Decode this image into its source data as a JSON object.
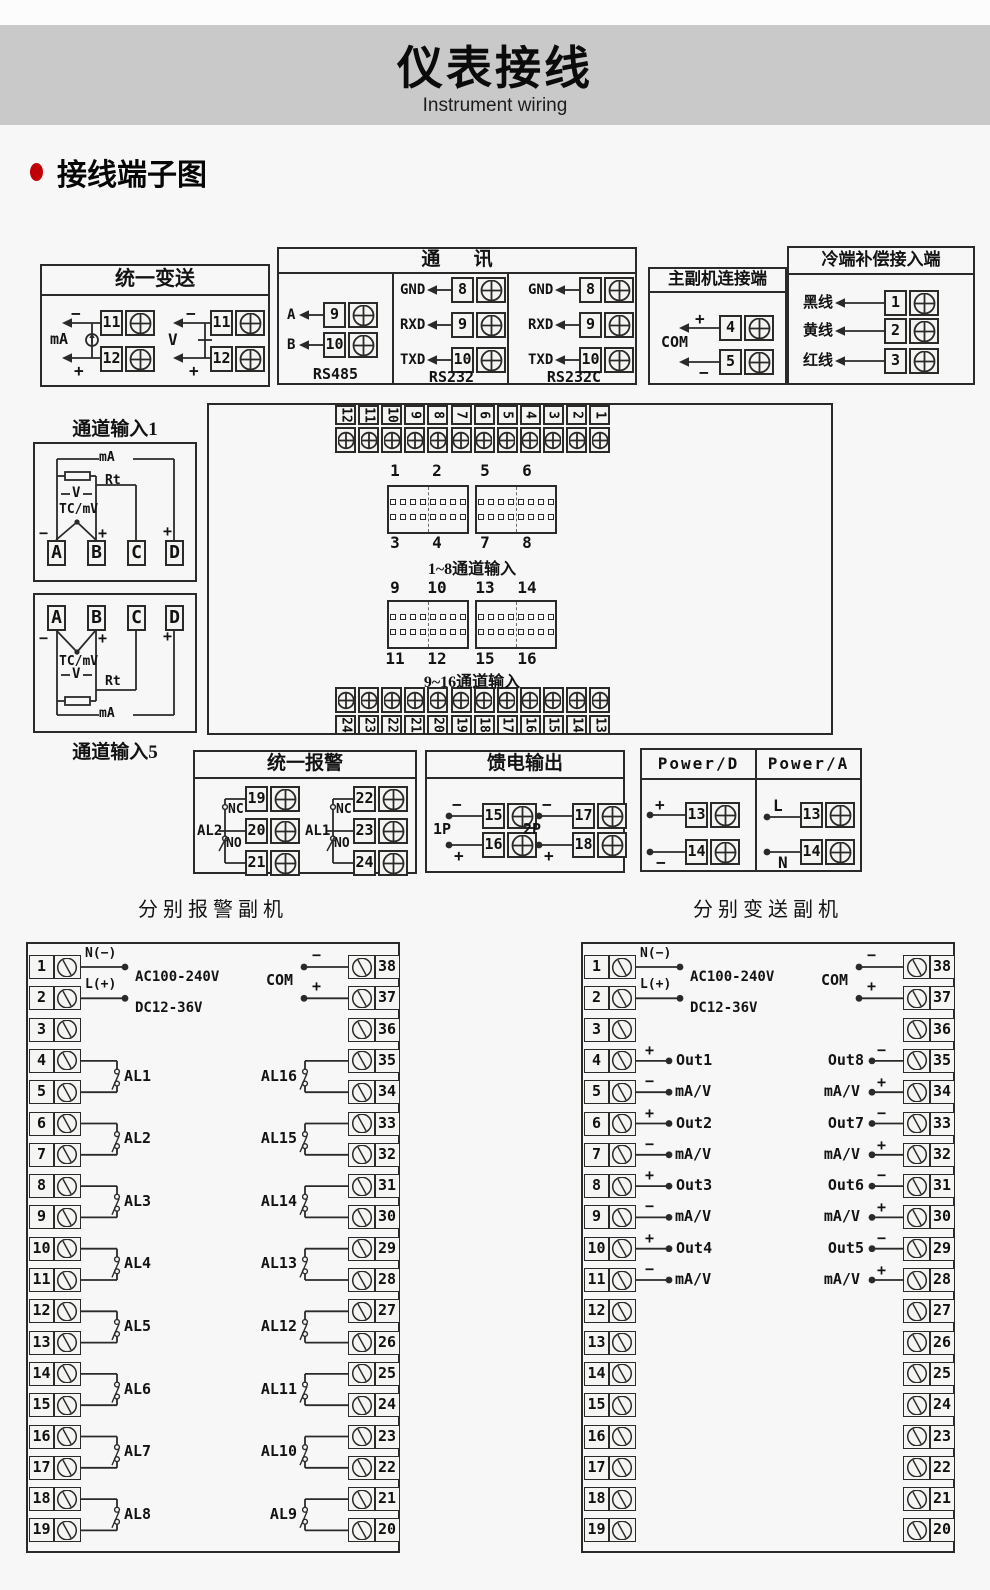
{
  "page": {
    "title": "仪表接线",
    "subtitle": "Instrument wiring",
    "section_title": "接线端子图"
  },
  "colors": {
    "accent_red": "#c00006",
    "line": "#2b2a28",
    "banner_bg": "#c9c9c9",
    "page_bg": "#f7f7f7"
  },
  "unified_transmit": {
    "title": "统一变送",
    "groups": [
      {
        "label": "mA",
        "minus": "−",
        "plus": "+",
        "terminals": [
          "11",
          "12"
        ]
      },
      {
        "label": "V",
        "minus": "−",
        "plus": "+",
        "terminals": [
          "11",
          "12"
        ]
      }
    ]
  },
  "comm": {
    "title": "通 讯",
    "columns": [
      {
        "caption": "RS485",
        "rows": [
          {
            "label": "A",
            "num": "9"
          },
          {
            "label": "B",
            "num": "10"
          }
        ]
      },
      {
        "caption": "RS232",
        "rows": [
          {
            "label": "GND",
            "num": "8"
          },
          {
            "label": "RXD",
            "num": "9"
          },
          {
            "label": "TXD",
            "num": "10"
          }
        ]
      },
      {
        "caption": "RS232C",
        "rows": [
          {
            "label": "GND",
            "num": "8"
          },
          {
            "label": "RXD",
            "num": "9"
          },
          {
            "label": "TXD",
            "num": "10"
          }
        ]
      }
    ]
  },
  "master_slave": {
    "title": "主副机连接端",
    "label": "COM",
    "rows": [
      {
        "sign": "+",
        "num": "4"
      },
      {
        "sign": "−",
        "num": "5"
      }
    ]
  },
  "cold_comp": {
    "title": "冷端补偿接入端",
    "rows": [
      {
        "label": "黑线",
        "num": "1"
      },
      {
        "label": "黄线",
        "num": "2"
      },
      {
        "label": "红线",
        "num": "3"
      }
    ]
  },
  "channel1": {
    "title": "通道输入1",
    "a": "A",
    "b": "B",
    "c": "C",
    "d": "D",
    "ma": "mA",
    "rt": "Rt",
    "v": "V",
    "tc": "TC/mV",
    "minus": "−",
    "plus_b": "+",
    "plus_d": "+"
  },
  "channel5": {
    "title": "通道输入5",
    "a": "A",
    "b": "B",
    "c": "C",
    "d": "D",
    "ma": "mA",
    "rt": "Rt",
    "v": "V",
    "tc": "TC/mV",
    "minus": "−",
    "plus_b": "+",
    "plus_d": "+"
  },
  "central": {
    "top_strip": [
      "12",
      "11",
      "10",
      "9",
      "8",
      "7",
      "6",
      "5",
      "4",
      "3",
      "2",
      "1"
    ],
    "bottom_strip": [
      "24",
      "23",
      "22",
      "21",
      "20",
      "19",
      "18",
      "17",
      "16",
      "15",
      "14",
      "13"
    ],
    "groups": [
      {
        "top": [
          "1",
          "2",
          "5",
          "6"
        ],
        "bottom": [
          "3",
          "4",
          "7",
          "8"
        ],
        "caption": "1~8通道输入"
      },
      {
        "top": [
          "9",
          "10",
          "13",
          "14"
        ],
        "bottom": [
          "11",
          "12",
          "15",
          "16"
        ],
        "caption": "9~16通道输入"
      }
    ]
  },
  "unified_alarm": {
    "title": "统一报警",
    "groups": [
      {
        "name": "AL2",
        "nc": "NC",
        "no": "NO",
        "terminals": [
          "19",
          "20",
          "21"
        ]
      },
      {
        "name": "AL1",
        "nc": "NC",
        "no": "NO",
        "terminals": [
          "22",
          "23",
          "24"
        ]
      }
    ]
  },
  "feed_output": {
    "title": "馈电输出",
    "groups": [
      {
        "name": "1P",
        "rows": [
          {
            "sign": "−",
            "num": "15"
          },
          {
            "sign": "+",
            "num": "16"
          }
        ]
      },
      {
        "name": "2P",
        "rows": [
          {
            "sign": "−",
            "num": "17"
          },
          {
            "sign": "+",
            "num": "18"
          }
        ]
      }
    ]
  },
  "power": {
    "columns": [
      {
        "title": "Power/D",
        "rows": [
          {
            "sign": "+",
            "num": "13"
          },
          {
            "sign": "−",
            "num": "14"
          }
        ]
      },
      {
        "title": "Power/A",
        "rows": [
          {
            "sign": "L",
            "num": "13"
          },
          {
            "sign": "N",
            "num": "14"
          }
        ]
      }
    ]
  },
  "alarm_slave": {
    "title": "分别报警副机",
    "power": {
      "n": "N(−)",
      "l": "L(+)",
      "ac": "AC100-240V",
      "dc": "DC12-36V",
      "com": "COM",
      "minus": "−",
      "plus": "+"
    },
    "left_terminals": [
      "1",
      "2",
      "3",
      "4",
      "5",
      "6",
      "7",
      "8",
      "9",
      "10",
      "11",
      "12",
      "13",
      "14",
      "15",
      "16",
      "17",
      "18",
      "19"
    ],
    "right_terminals": [
      "38",
      "37",
      "36",
      "35",
      "34",
      "33",
      "32",
      "31",
      "30",
      "29",
      "28",
      "27",
      "26",
      "25",
      "24",
      "23",
      "22",
      "21",
      "20"
    ],
    "left_groups": [
      {
        "name": "AL1"
      },
      {
        "name": "AL2"
      },
      {
        "name": "AL3"
      },
      {
        "name": "AL4"
      },
      {
        "name": "AL5"
      },
      {
        "name": "AL6"
      },
      {
        "name": "AL7"
      },
      {
        "name": "AL8"
      }
    ],
    "right_groups": [
      {
        "name": "AL16"
      },
      {
        "name": "AL15"
      },
      {
        "name": "AL14"
      },
      {
        "name": "AL13"
      },
      {
        "name": "AL12"
      },
      {
        "name": "AL11"
      },
      {
        "name": "AL10"
      },
      {
        "name": "AL9"
      }
    ]
  },
  "transmit_slave": {
    "title": "分别变送副机",
    "power": {
      "n": "N(−)",
      "l": "L(+)",
      "ac": "AC100-240V",
      "dc": "DC12-36V",
      "com": "COM",
      "minus": "−",
      "plus": "+"
    },
    "left_terminals": [
      "1",
      "2",
      "3",
      "4",
      "5",
      "6",
      "7",
      "8",
      "9",
      "10",
      "11",
      "12",
      "13",
      "14",
      "15",
      "16",
      "17",
      "18",
      "19"
    ],
    "right_terminals": [
      "38",
      "37",
      "36",
      "35",
      "34",
      "33",
      "32",
      "31",
      "30",
      "29",
      "28",
      "27",
      "26",
      "25",
      "24",
      "23",
      "22",
      "21",
      "20"
    ],
    "left_groups": [
      {
        "name": "Out1",
        "unit": "mA/V",
        "plus": "+",
        "minus": "−"
      },
      {
        "name": "Out2",
        "unit": "mA/V",
        "plus": "+",
        "minus": "−"
      },
      {
        "name": "Out3",
        "unit": "mA/V",
        "plus": "+",
        "minus": "−"
      },
      {
        "name": "Out4",
        "unit": "mA/V",
        "plus": "+",
        "minus": "−"
      }
    ],
    "right_groups": [
      {
        "name": "Out8",
        "unit": "mA/V",
        "plus": "+",
        "minus": "−"
      },
      {
        "name": "Out7",
        "unit": "mA/V",
        "plus": "+",
        "minus": "−"
      },
      {
        "name": "Out6",
        "unit": "mA/V",
        "plus": "+",
        "minus": "−"
      },
      {
        "name": "Out5",
        "unit": "mA/V",
        "plus": "+",
        "minus": "−"
      }
    ]
  }
}
